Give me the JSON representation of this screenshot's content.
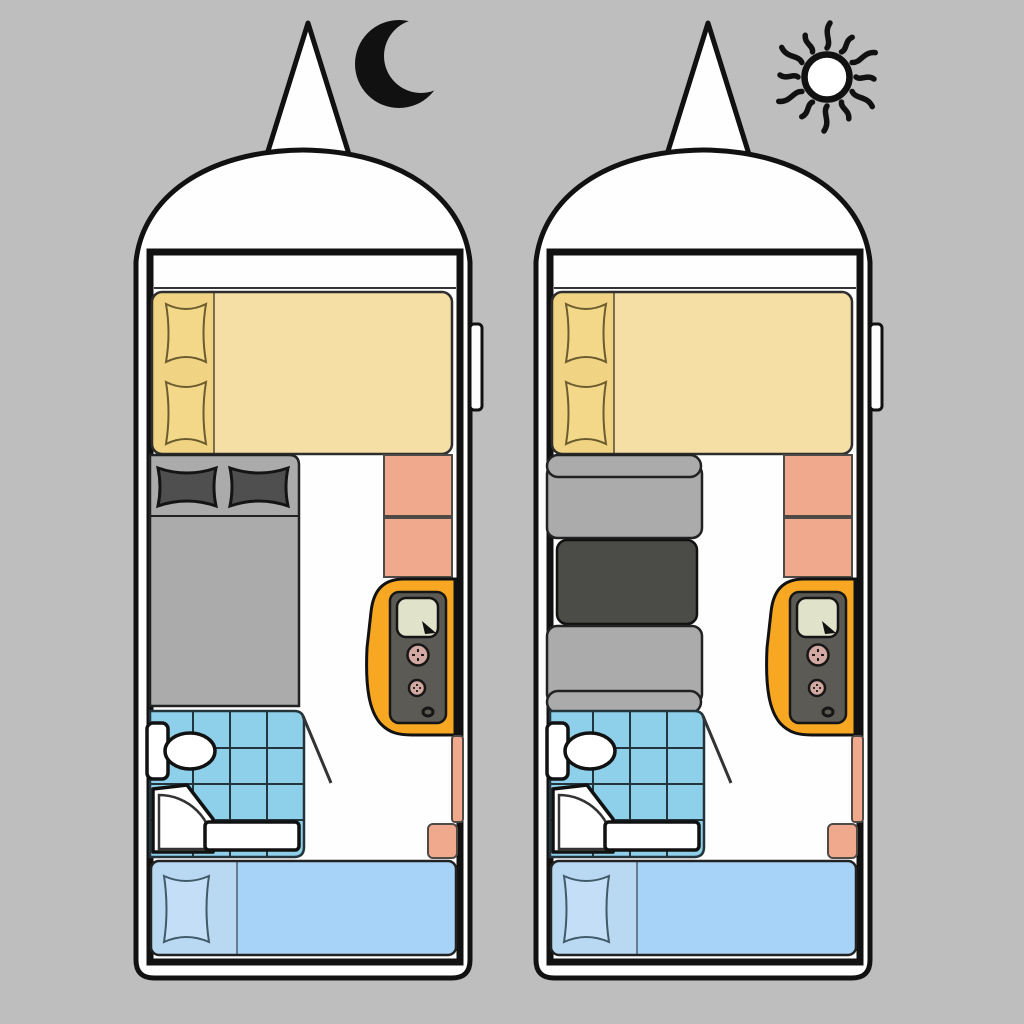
{
  "meta": {
    "title": "Caravan floor plan — night and day configurations",
    "text_on_screen": []
  },
  "colors": {
    "bg": "#BEBEBE",
    "outline": "#111111",
    "body": "#FEFEFE",
    "bed_yellow": "#F5DFA4",
    "pillow_strip_yellow": "#F1D384",
    "pillow_yellow": "#F3D88A",
    "bed_gray": "#ABABAB",
    "pillow_dark": "#4F4F4F",
    "cabinet_salmon": "#F1A98D",
    "appliance_orange": "#F7A722",
    "appliance_panel": "#5C5A54",
    "appliance_screen": "#E0E3C9",
    "knob_pink": "#D2A8A2",
    "tile_blue": "#8ECFE9",
    "bed_blue": "#A6D3F7",
    "pillow_strip_blue": "#B9D9F3",
    "pillow_blue": "#C3DEF6",
    "table_dark": "#4B4B47"
  },
  "panels": [
    {
      "id": "night",
      "mode_icon": "moon-icon",
      "middle_section": "double-bed-with-two-dark-pillows",
      "shared_features": [
        "hitch-triangle",
        "dome-front",
        "front-double-bed-two-pillows",
        "two-salmon-cabinets",
        "orange-heater-unit",
        "tiled-bathroom-toilet-shower",
        "door-swing-line",
        "salmon-side-shelves",
        "rear-single-bed-one-pillow",
        "side-door-handle"
      ]
    },
    {
      "id": "day",
      "mode_icon": "sun-icon",
      "middle_section": "dinette-two-bench-seats-with-dark-table",
      "shared_features": [
        "hitch-triangle",
        "dome-front",
        "front-double-bed-two-pillows",
        "two-salmon-cabinets",
        "orange-heater-unit",
        "tiled-bathroom-toilet-shower",
        "door-swing-line",
        "salmon-side-shelves",
        "rear-single-bed-one-pillow",
        "side-door-handle"
      ]
    }
  ]
}
